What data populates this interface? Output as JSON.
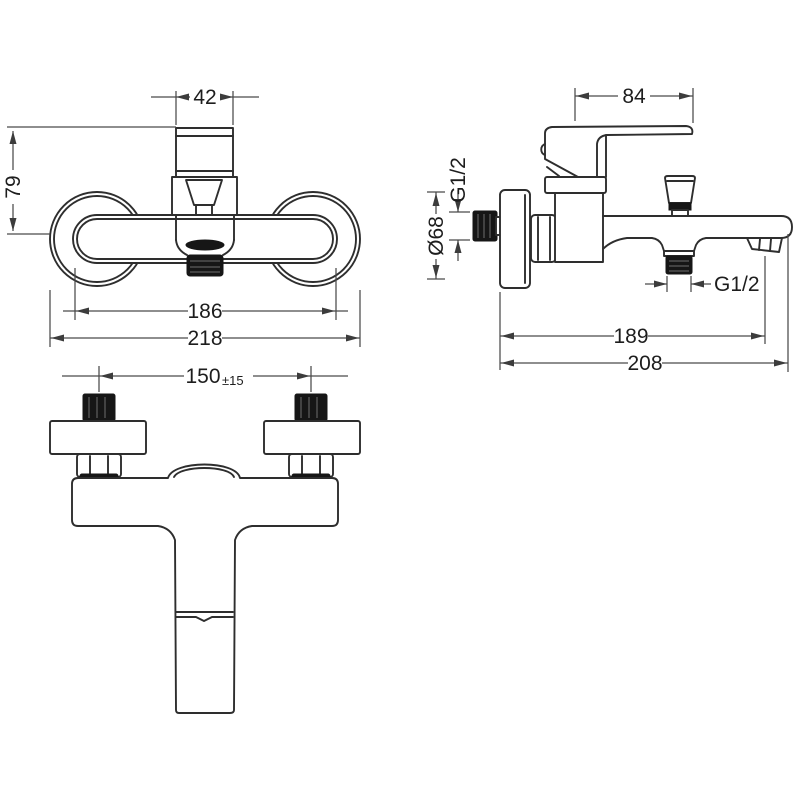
{
  "page": {
    "background": "#ffffff"
  },
  "drawing": {
    "type": "technical-dimension-drawing",
    "subject": "wall-mounted bath mixer tap, three orthographic views",
    "colors": {
      "line": "#2e2e2e",
      "dimension": "#4a4a4a",
      "thread_fill": "#161616",
      "text": "#1d1d1d"
    },
    "views": {
      "front": {
        "dims": {
          "handle_width": "42",
          "height": "79",
          "body_width": "186",
          "overall_width": "218"
        }
      },
      "side": {
        "dims": {
          "lever_length": "84",
          "inlet_thread": "G1/2",
          "flange_diameter": "Ø68",
          "outlet_thread": "G1/2",
          "spout_reach": "189",
          "overall_depth": "208"
        }
      },
      "top": {
        "dims": {
          "centres_value": "150",
          "centres_tolerance": "±15"
        }
      }
    }
  }
}
